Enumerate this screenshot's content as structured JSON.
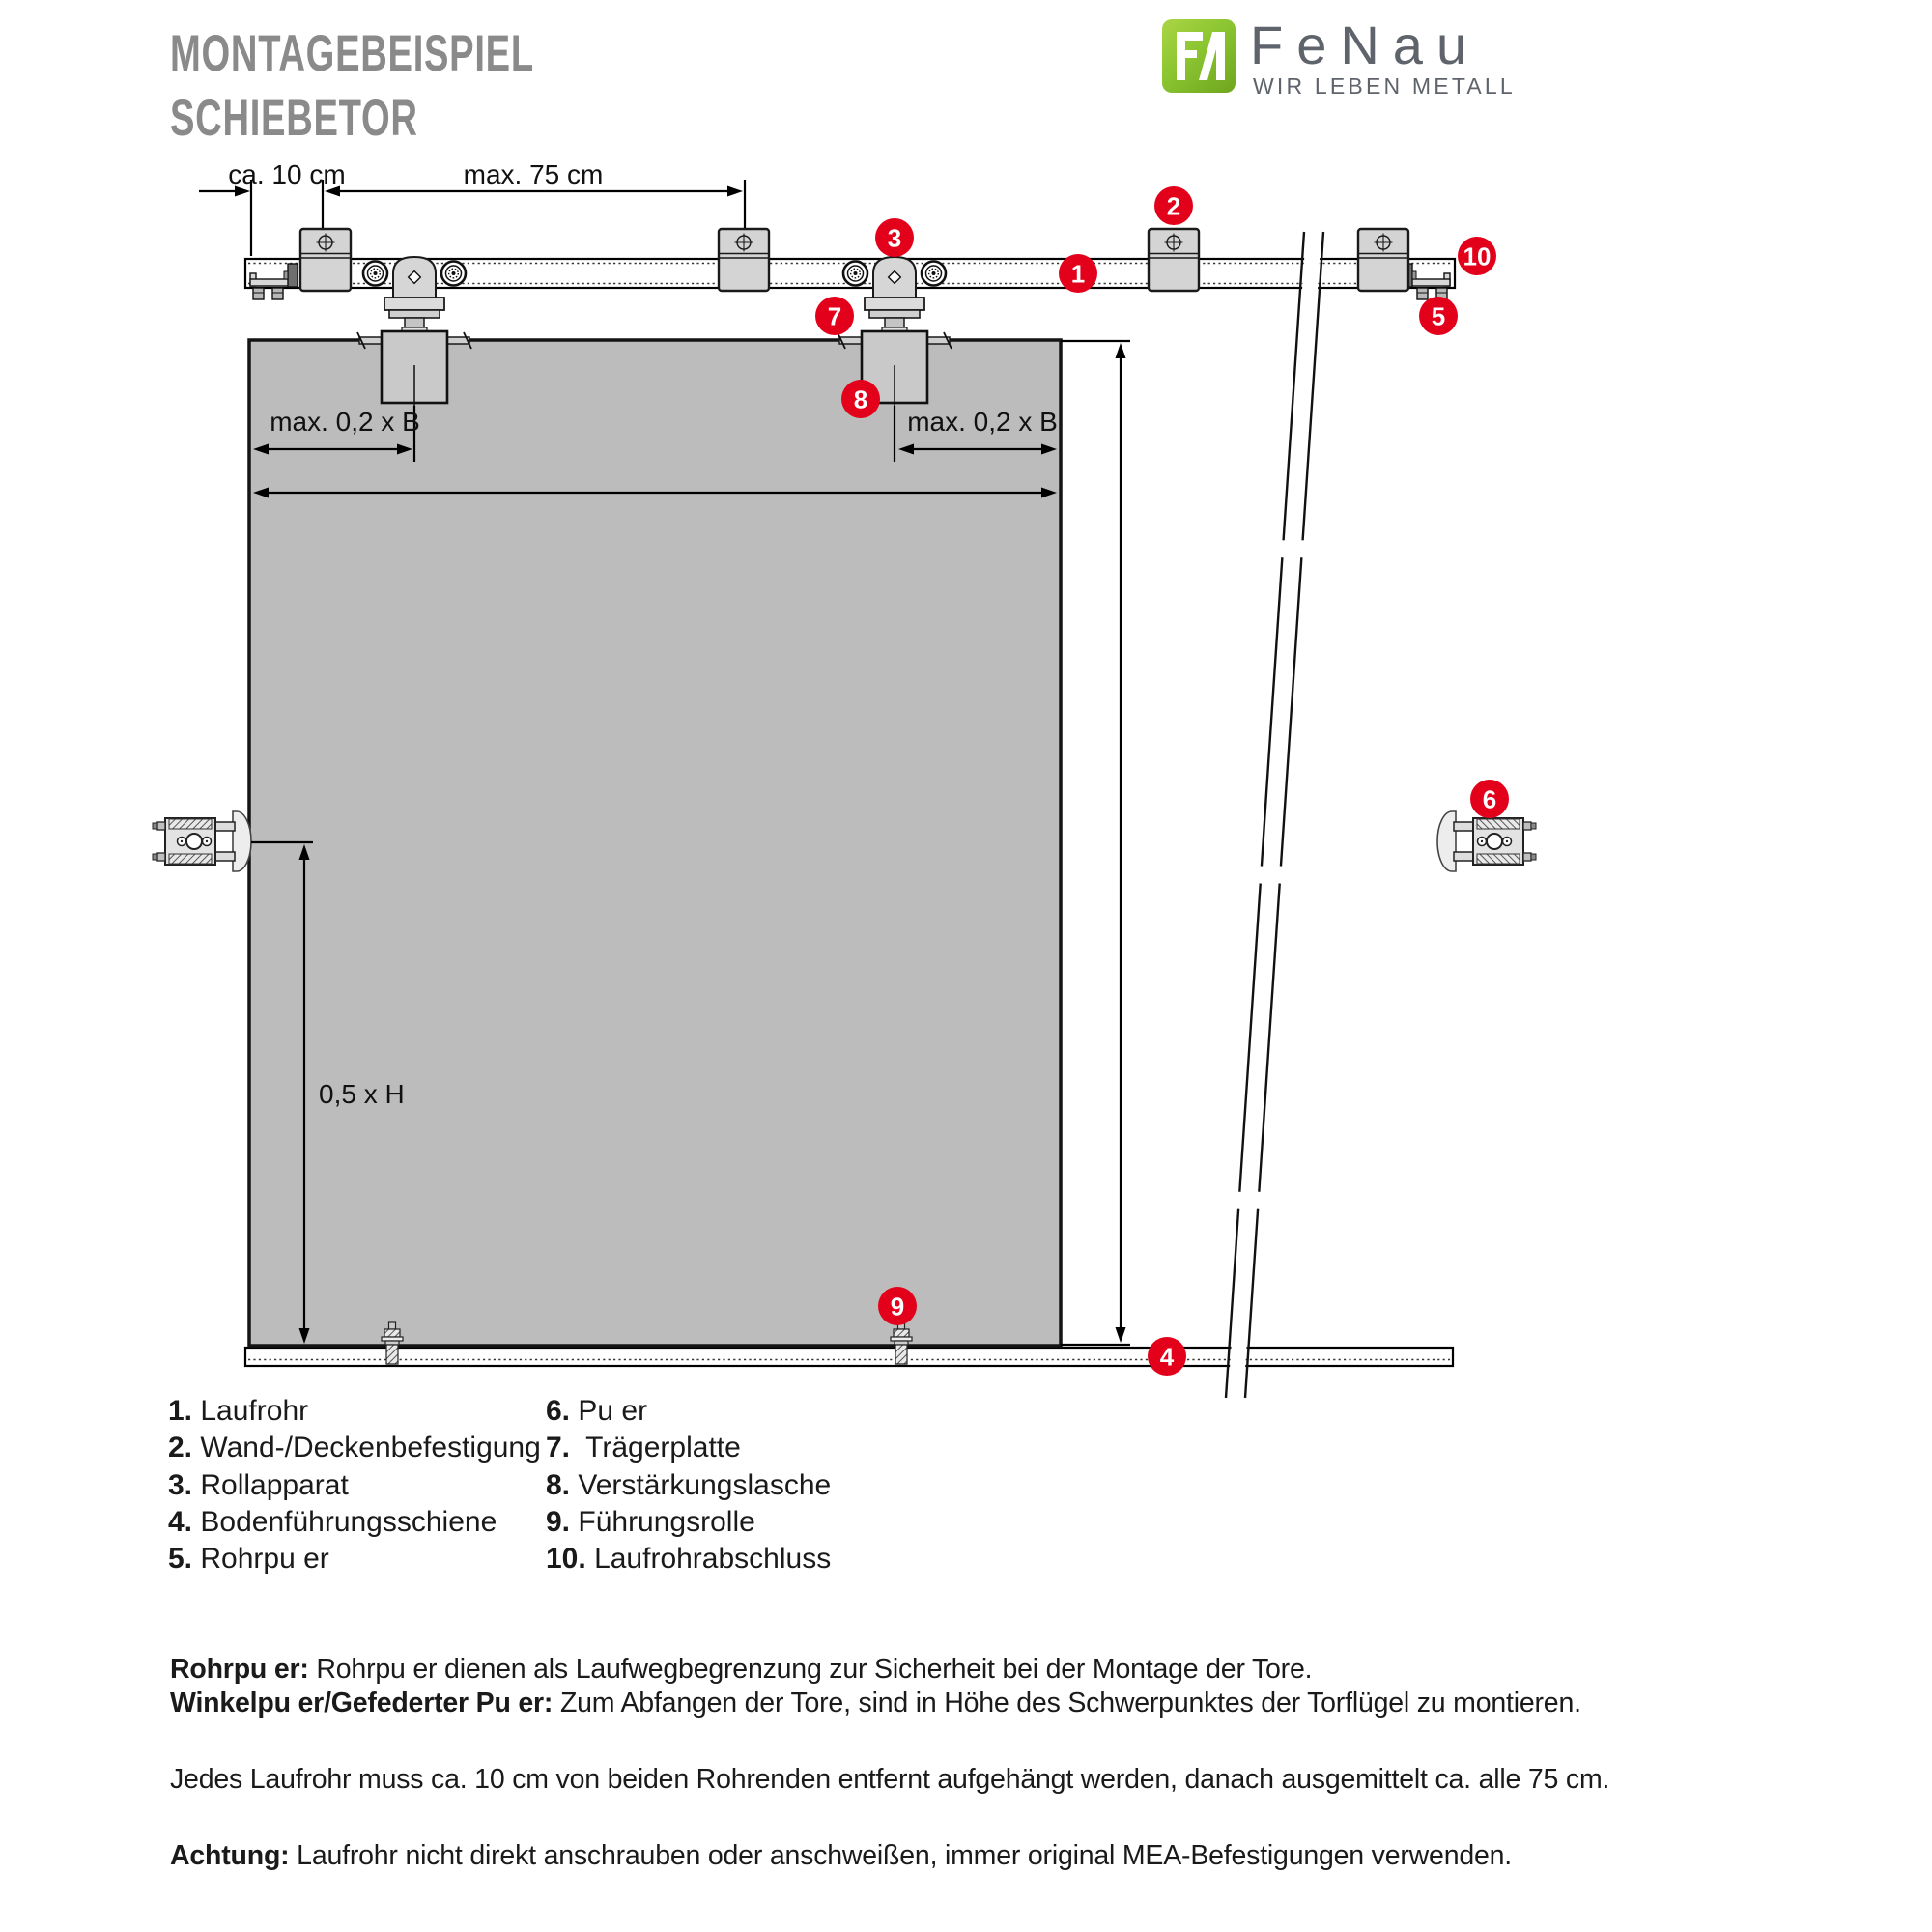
{
  "header": {
    "title_line1": "MONTAGEBEISPIEL",
    "title_line2": "SCHIEBETOR",
    "logo": {
      "monogram": "FA",
      "brand": "FeNau",
      "tagline": "WIR LEBEN METALL"
    }
  },
  "diagram": {
    "labels": {
      "top_offset": "ca. 10 cm",
      "top_spacing": "max. 75 cm",
      "door_left": "max. 0,2 x B",
      "door_right": "max. 0,2 x B",
      "height_half": "0,5 x H"
    },
    "callouts": [
      "1",
      "2",
      "3",
      "4",
      "5",
      "6",
      "7",
      "8",
      "9",
      "10"
    ]
  },
  "legend": {
    "items": [
      {
        "num": "1.",
        "label": "Laufrohr"
      },
      {
        "num": "2.",
        "label": "Wand-/Deckenbefestigung"
      },
      {
        "num": "3.",
        "label": "Rollapparat"
      },
      {
        "num": "4.",
        "label": "Bodenführungsschiene"
      },
      {
        "num": "5.",
        "label": "Rohrpu er"
      },
      {
        "num": "6.",
        "label": "Pu er"
      },
      {
        "num": "7.",
        "label": "Trägerplatte"
      },
      {
        "num": "8.",
        "label": "Verstärkungslasche"
      },
      {
        "num": "9.",
        "label": "Führungsrolle"
      },
      {
        "num": "10.",
        "label": "Laufrohrabschluss"
      }
    ]
  },
  "notes": [
    {
      "head": "Rohrpu er:",
      "text": "Rohrpu er dienen als Laufwegbegrenzung zur Sicherheit bei der Montage der Tore."
    },
    {
      "head": "Winkelpu er/Gefederter Pu er:",
      "text": "Zum Abfangen der Tore, sind in Höhe des Schwerpunktes der Torflügel zu montieren."
    },
    {
      "head": "",
      "text": "Jedes Laufrohr muss ca. 10 cm von beiden Rohrenden entfernt aufgehängt werden, danach ausgemittelt ca. alle 75 cm."
    },
    {
      "head": "Achtung:",
      "text": "Laufrohr nicht direkt anschrauben oder anschweißen, immer original MEA-Befestigungen verwenden."
    }
  ],
  "colors": {
    "accent_red": "#e2001a",
    "logo_green": "#8bc531",
    "door_gray": "#bcbcbc",
    "title_gray": "#8a8a8a"
  }
}
